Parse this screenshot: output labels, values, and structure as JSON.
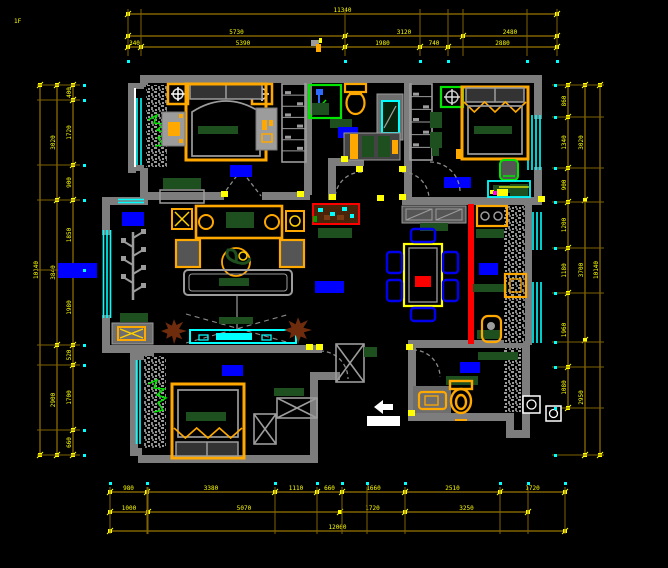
{
  "page": {
    "type": "cad-apartment-floor-plan",
    "background": "#000000"
  },
  "colors": {
    "wall": "#7d7d7d",
    "furniture_outline": "#9c9c9c",
    "window": "#00ffff",
    "dimension_text": "#ffff00",
    "dimension_line": "#7f6200",
    "wood_furniture": "#ffa800",
    "dark_green_fabric": "#1e4f1e",
    "bright_green_fixture": "#00e600",
    "room_label_highlight": "#0000ff",
    "kitchen_divider_red": "#ff0000",
    "plant_brown": "#6f2c0d",
    "white_fixture": "#ffffff",
    "utility_magenta": "#ff00ff"
  },
  "dimensions": {
    "top": {
      "rows": [
        [
          "11340"
        ],
        [
          "5730",
          "3120",
          "2480"
        ],
        [
          "340",
          "5390",
          "1980",
          "740",
          "2880"
        ]
      ]
    },
    "bottom": {
      "rows": [
        [
          "980",
          "3380",
          "1110",
          "660",
          "1660",
          "2510",
          "1720"
        ],
        [
          "1000",
          "5070",
          "1720",
          "3250"
        ],
        [
          "12060"
        ]
      ]
    },
    "left": {
      "cols": [
        [
          "400",
          "1720",
          "900",
          "1850",
          "1980",
          "520",
          "1700",
          "660"
        ],
        [
          "3020",
          "3840",
          "2900"
        ],
        [
          "10140"
        ]
      ]
    },
    "right": {
      "cols": [
        [
          "860",
          "1340",
          "900",
          "1200",
          "1180",
          "1960",
          "1080"
        ],
        [
          "3020",
          "3700",
          "2950"
        ],
        [
          "10140"
        ]
      ]
    },
    "corner_mark": "1F"
  },
  "icons": {
    "ceiling-lamp-icon": "orange box with white fan cross",
    "ceiling-fan-icon": "green box with gray fan cross",
    "table-lamp-icon": "yellow X in orange square",
    "shower-icon": "green enclosure with blue shower head",
    "toilet-icon": "orange tank and bowl",
    "washbasin-icon": "orange rounded basin",
    "mirror-icon": "cyan rectangle",
    "tv-icon": "cyan screen on cyan media wall",
    "sofa-icon": "orange frame with green cushions",
    "dining-table-icon": "yellow table, blue chairs, red runner",
    "stove-icon": "orange cooktop with gray burners",
    "sink-icon": "orange basin square",
    "washing-machine-icon": "white box with drum circle",
    "plant-icon": "green scribble / brown splat",
    "branch-plant-icon": "gray branch with square leaves",
    "aquarium-icon": "red framed cabinet with pebbles",
    "north-arrow-icon": "small white arrow",
    "door-swing-icon": "dashed gray arc",
    "room-label": "blue highlighted text block (illegible at this zoom)"
  }
}
